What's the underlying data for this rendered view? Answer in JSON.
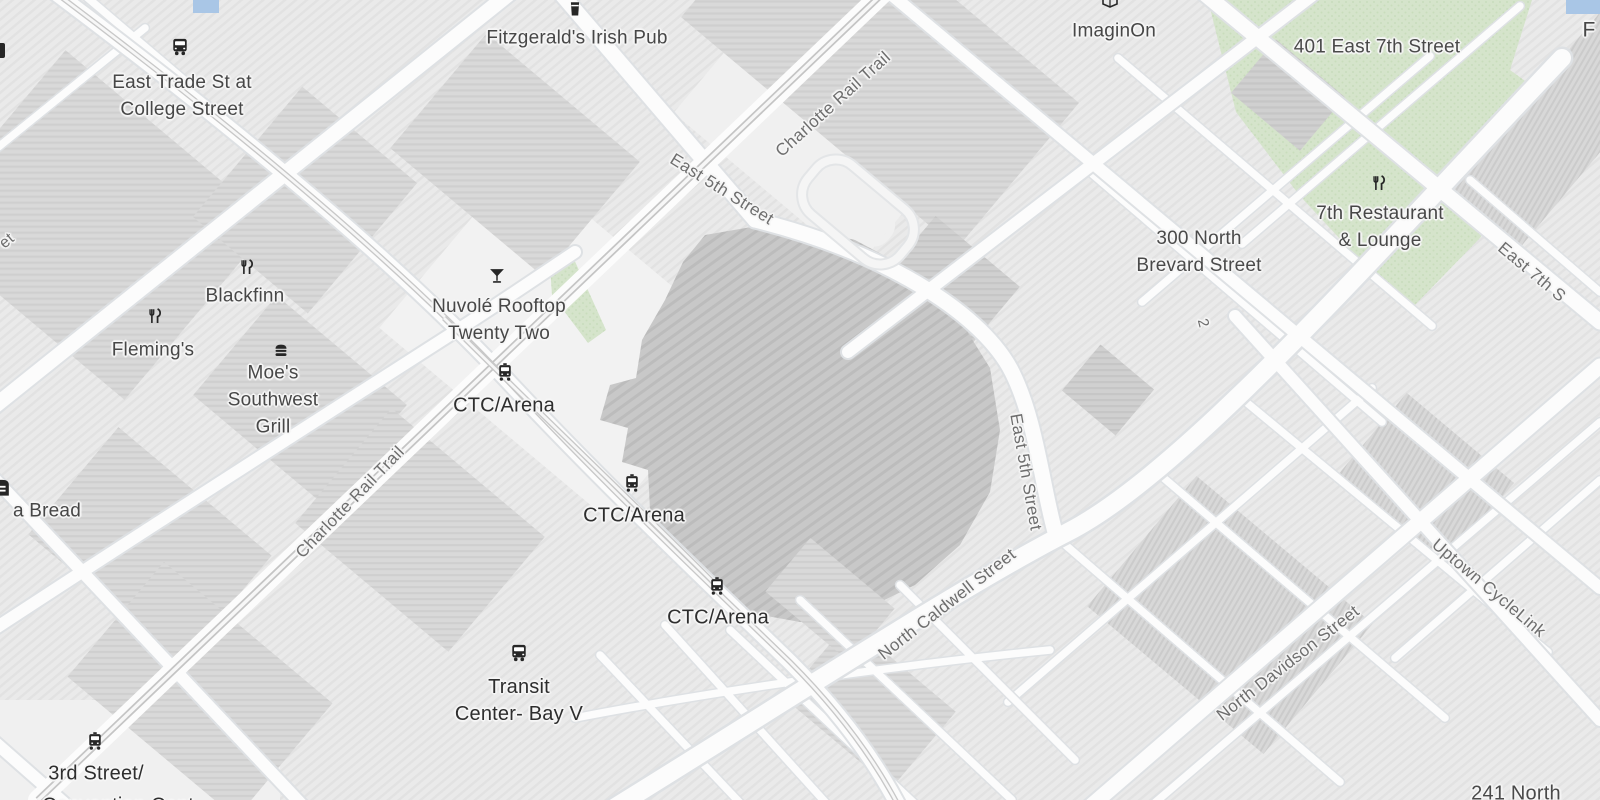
{
  "map": {
    "style": "grayscale-city-map",
    "colors": {
      "road_fill": "#fcfcfc",
      "road_casing": "#dee1e4",
      "block": "#eaeaea",
      "building": "#d8d8d8",
      "building_dark": "#cfcfcf",
      "arena": "#c8c8c8",
      "park_green": "#d5e4cb",
      "water_blue": "#a9c6e6",
      "rail_gray": "#c5c5c5",
      "label_street": "#6e6e6e",
      "label_poi": "#474747",
      "label_transit": "#2e2e2e",
      "icon_dark": "#262626"
    },
    "icons": [
      "bus-icon",
      "tram-icon",
      "pint-icon",
      "cocktail-icon",
      "restaurant-icon",
      "burger-icon",
      "book-icon",
      "bread-icon"
    ]
  },
  "labels": {
    "bus_stop_trade": {
      "line1": "East Trade St at",
      "line2": "College Street"
    },
    "fitzgeralds": "Fitzgerald's Irish Pub",
    "rail_trail_top": "Charlotte Rail Trail",
    "imaginon": "ImaginOn",
    "addr_401": "401 East 7th Street",
    "f_partial": "F",
    "east_5th_top": "East 5th Street",
    "addr_300": {
      "line1": "300 North",
      "line2": "Brevard Street"
    },
    "seventh_restaurant": {
      "line1": "7th Restaurant",
      "line2": "& Lounge"
    },
    "east_7th_edge": "East 7th S",
    "route_two": "2",
    "blackfinn": "Blackfinn",
    "flemings": "Fleming's",
    "nuvole": {
      "line1": "Nuvolé Rooftop",
      "line2": "Twenty Two"
    },
    "moes": {
      "line1": "Moe's",
      "line2": "Southwest",
      "line3": "Grill"
    },
    "ctc1": "CTC/Arena",
    "ctc2": "CTC/Arena",
    "ctc3": "CTC/Arena",
    "rail_trail_left": "Charlotte Rail Trail",
    "bread": "a Bread",
    "east_5th_right": "East 5th Street",
    "n_caldwell": "North Caldwell Street",
    "n_davidson": "North Davidson Street",
    "uptown_cyclelink": "Uptown CycleLink",
    "transit_center": {
      "line1": "Transit",
      "line2": "Center- Bay V"
    },
    "third_street": {
      "line1": "3rd Street/",
      "line2": "Convention Cent"
    },
    "addr_241": "241 North",
    "street_fragment_et": "et"
  }
}
